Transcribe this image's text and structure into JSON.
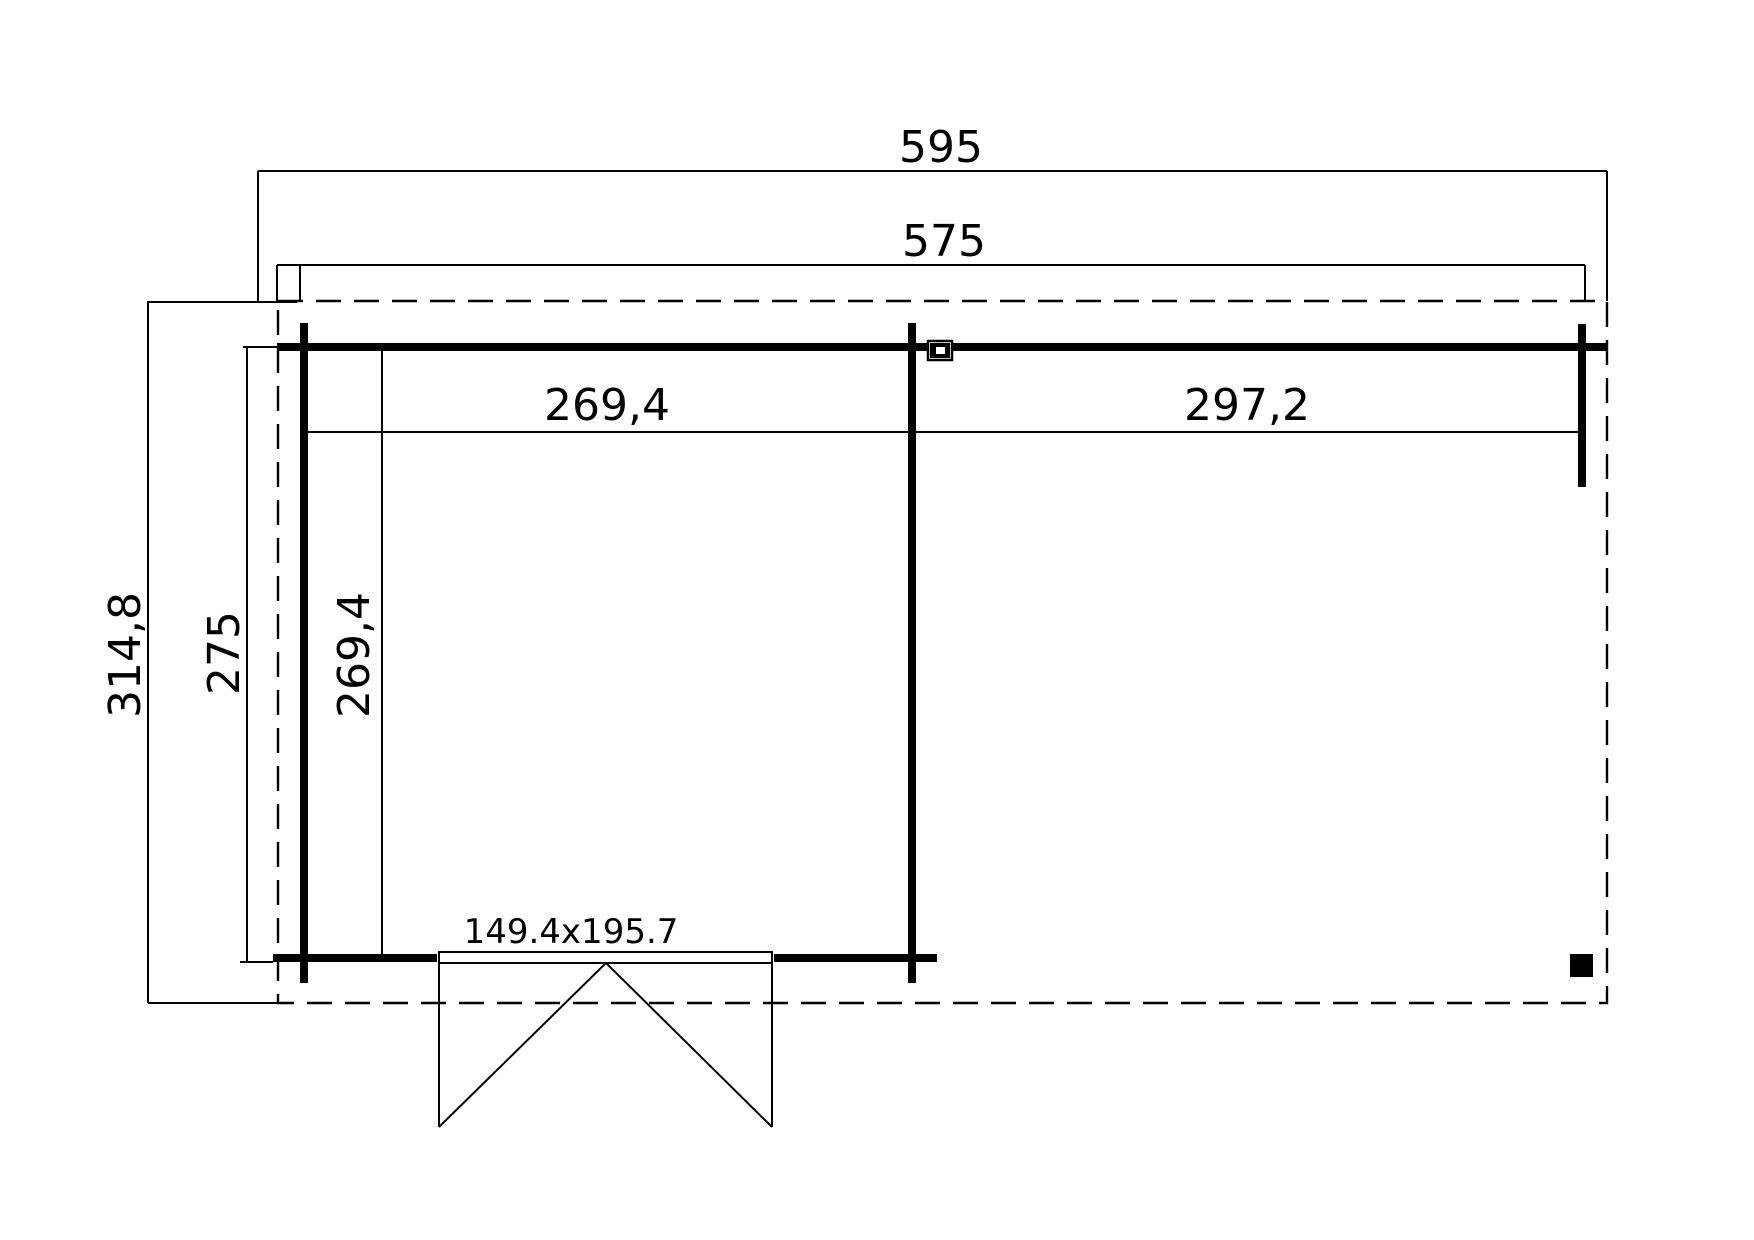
{
  "page": {
    "background": "#ffffff",
    "line_color": "#000000"
  },
  "plan": {
    "type": "floor-plan-top-view",
    "labels": {
      "overall_width": "595",
      "wall_outer_width": "575",
      "room_inner_width": "269,4",
      "terrace_inner_width": "297,2",
      "overall_depth": "314,8",
      "wall_outer_depth": "275",
      "room_inner_depth": "269,4",
      "door_size": "149.4x195.7"
    }
  }
}
